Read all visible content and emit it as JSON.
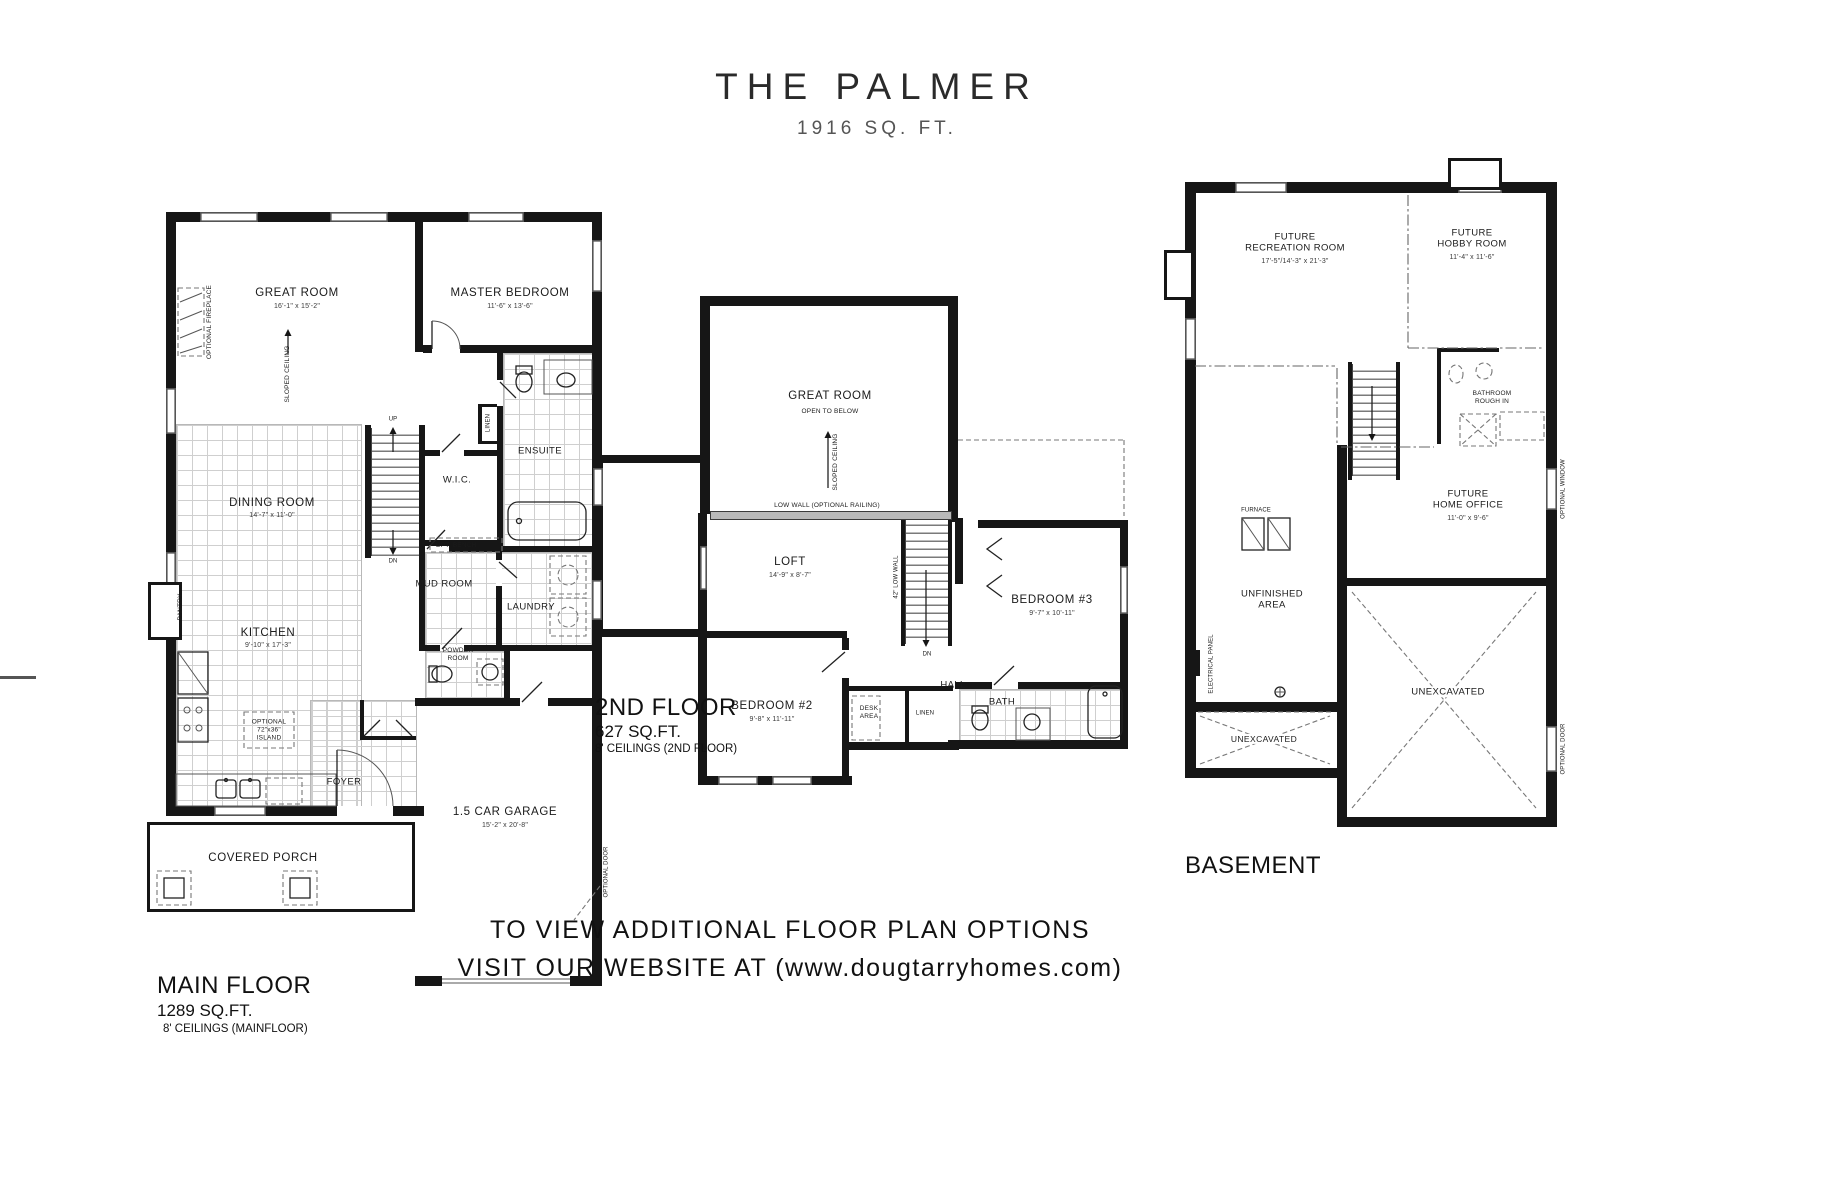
{
  "title": {
    "name": "THE PALMER",
    "sqft": "1916 SQ. FT."
  },
  "footer": {
    "line1": "TO VIEW ADDITIONAL FLOOR PLAN OPTIONS",
    "line2": "VISIT OUR WEBSITE AT (www.dougtarryhomes.com)"
  },
  "main_floor": {
    "caption": {
      "title": "MAIN FLOOR",
      "sqft": "1289 SQ.FT.",
      "ceilings": "8' CEILINGS (MAINFLOOR)"
    },
    "rooms": {
      "great_room": {
        "label": "GREAT ROOM",
        "dims": "16'-1\" x 15'-2\""
      },
      "master_bedroom": {
        "label": "MASTER BEDROOM",
        "dims": "11'-6\" x 13'-6\""
      },
      "dining_room": {
        "label": "DINING ROOM",
        "dims": "14'-7\" x 11'-0\""
      },
      "kitchen": {
        "label": "KITCHEN",
        "dims": "9'-10\" x 17'-3\""
      },
      "garage": {
        "label": "1.5 CAR GARAGE",
        "dims": "15'-2\" x 20'-8\""
      },
      "ensuite": {
        "label": "ENSUITE"
      },
      "wic": {
        "label": "W.I.C."
      },
      "mud_room": {
        "label": "MUD ROOM"
      },
      "laundry": {
        "label": "LAUNDRY"
      },
      "powder_room": {
        "l1": "POWDER",
        "l2": "ROOM"
      },
      "foyer": {
        "label": "FOYER"
      },
      "covered_porch": {
        "label": "COVERED PORCH"
      }
    },
    "annotations": {
      "optional_fireplace": "OPTIONAL FIREPLACE",
      "sloped_ceiling": "SLOPED CEILING",
      "pantry": "PANTRY",
      "linen": "LINEN",
      "opt_bench": "OPT. BENCH",
      "island_l1": "OPTIONAL",
      "island_l2": "72\"x36\"",
      "island_l3": "ISLAND",
      "up": "UP",
      "dn": "DN",
      "optional_door": "OPTIONAL DOOR"
    }
  },
  "second_floor": {
    "caption": {
      "title": "2ND FLOOR",
      "sqft": "627 SQ.FT.",
      "ceilings": "8' CEILINGS (2ND FLOOR)"
    },
    "rooms": {
      "great_room": {
        "label": "GREAT ROOM",
        "note": "OPEN TO BELOW"
      },
      "loft": {
        "label": "LOFT",
        "dims": "14'-9\" x 8'-7\""
      },
      "bedroom_2": {
        "label": "BEDROOM #2",
        "dims": "9'-8\" x 11'-11\""
      },
      "bedroom_3": {
        "label": "BEDROOM #3",
        "dims": "9'-7\" x 10'-11\""
      },
      "bath": {
        "label": "BATH"
      },
      "hall": {
        "label": "HALL"
      },
      "desk_area": {
        "l1": "DESK",
        "l2": "AREA"
      },
      "linen": {
        "label": "LINEN"
      }
    },
    "annotations": {
      "sloped_ceiling": "SLOPED CEILING",
      "low_wall": "LOW WALL (OPTIONAL RAILING)",
      "low_wall_42": "42\" LOW WALL",
      "dn": "DN"
    }
  },
  "basement": {
    "caption": {
      "title": "BASEMENT"
    },
    "rooms": {
      "recreation": {
        "l1": "FUTURE",
        "l2": "RECREATION ROOM",
        "dims": "17'-5\"/14'-3\" x 21'-3\""
      },
      "hobby": {
        "l1": "FUTURE",
        "l2": "HOBBY ROOM",
        "dims": "11'-4\" x 11'-6\""
      },
      "home_office": {
        "l1": "FUTURE",
        "l2": "HOME OFFICE",
        "dims": "11'-0\" x 9'-6\""
      },
      "bathroom_rough_in": {
        "l1": "BATHROOM",
        "l2": "ROUGH IN"
      },
      "unfinished": {
        "l1": "UNFINISHED",
        "l2": "AREA"
      },
      "unexcavated_small": {
        "label": "UNEXCAVATED"
      },
      "unexcavated_large": {
        "label": "UNEXCAVATED"
      }
    },
    "annotations": {
      "furnace": "FURNACE",
      "electrical_panel": "ELECTRICAL PANEL",
      "optional_window": "OPTIONAL WINDOW",
      "optional_door": "OPTIONAL DOOR"
    }
  }
}
